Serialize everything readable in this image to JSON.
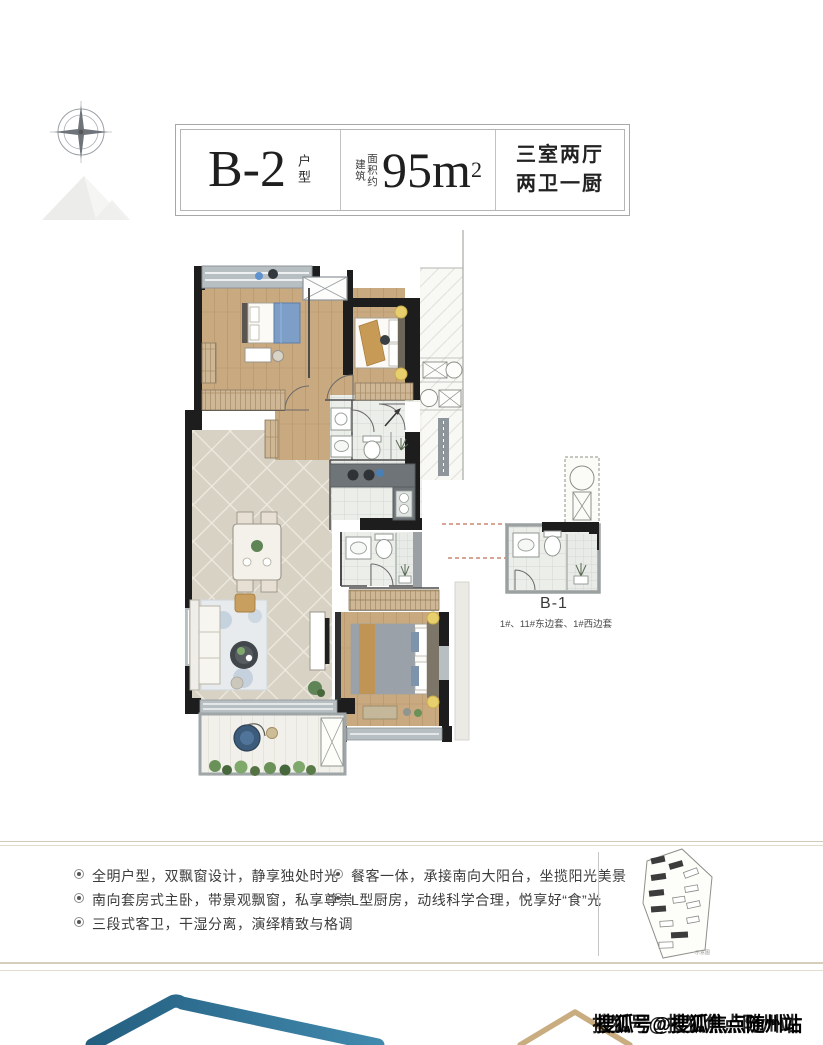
{
  "title_block": {
    "unit_code": "B-2",
    "unit_type_label": "户型",
    "area_label_col1": "建筑",
    "area_label_col2": "面积约",
    "area_value": "95m",
    "area_superscript": "2",
    "layout_line1": "三室两厅",
    "layout_line2": "两卫一厨"
  },
  "floor_plan": {
    "inset_label": "B-1",
    "inset_caption": "1#、11#东边套、1#西边套"
  },
  "features": {
    "left": [
      "全明户型，双飘窗设计，静享独处时光",
      "南向套房式主卧，带景观飘窗，私享尊崇",
      "三段式客卫，干湿分离，演绎精致与格调"
    ],
    "right": [
      "餐客一体，承接南向大阳台，坐揽阳光美景",
      "L型厨房，动线科学合理，悦享好“食”光"
    ]
  },
  "site_map": {
    "caption": "示意图"
  },
  "watermark": "搜狐号@搜狐焦点随州站",
  "colors": {
    "wall": "#1d1d1d",
    "wood": "#c9aa80",
    "tile": "#edefeb",
    "diamond_tile": "#d8d2c5",
    "accent_blue": "#7d9ec7",
    "accent_yellow": "#e8cf6d",
    "logo_blue": "#2e7396",
    "logo_tan": "#c9ad80",
    "connector_dash": "#bf6f55"
  }
}
